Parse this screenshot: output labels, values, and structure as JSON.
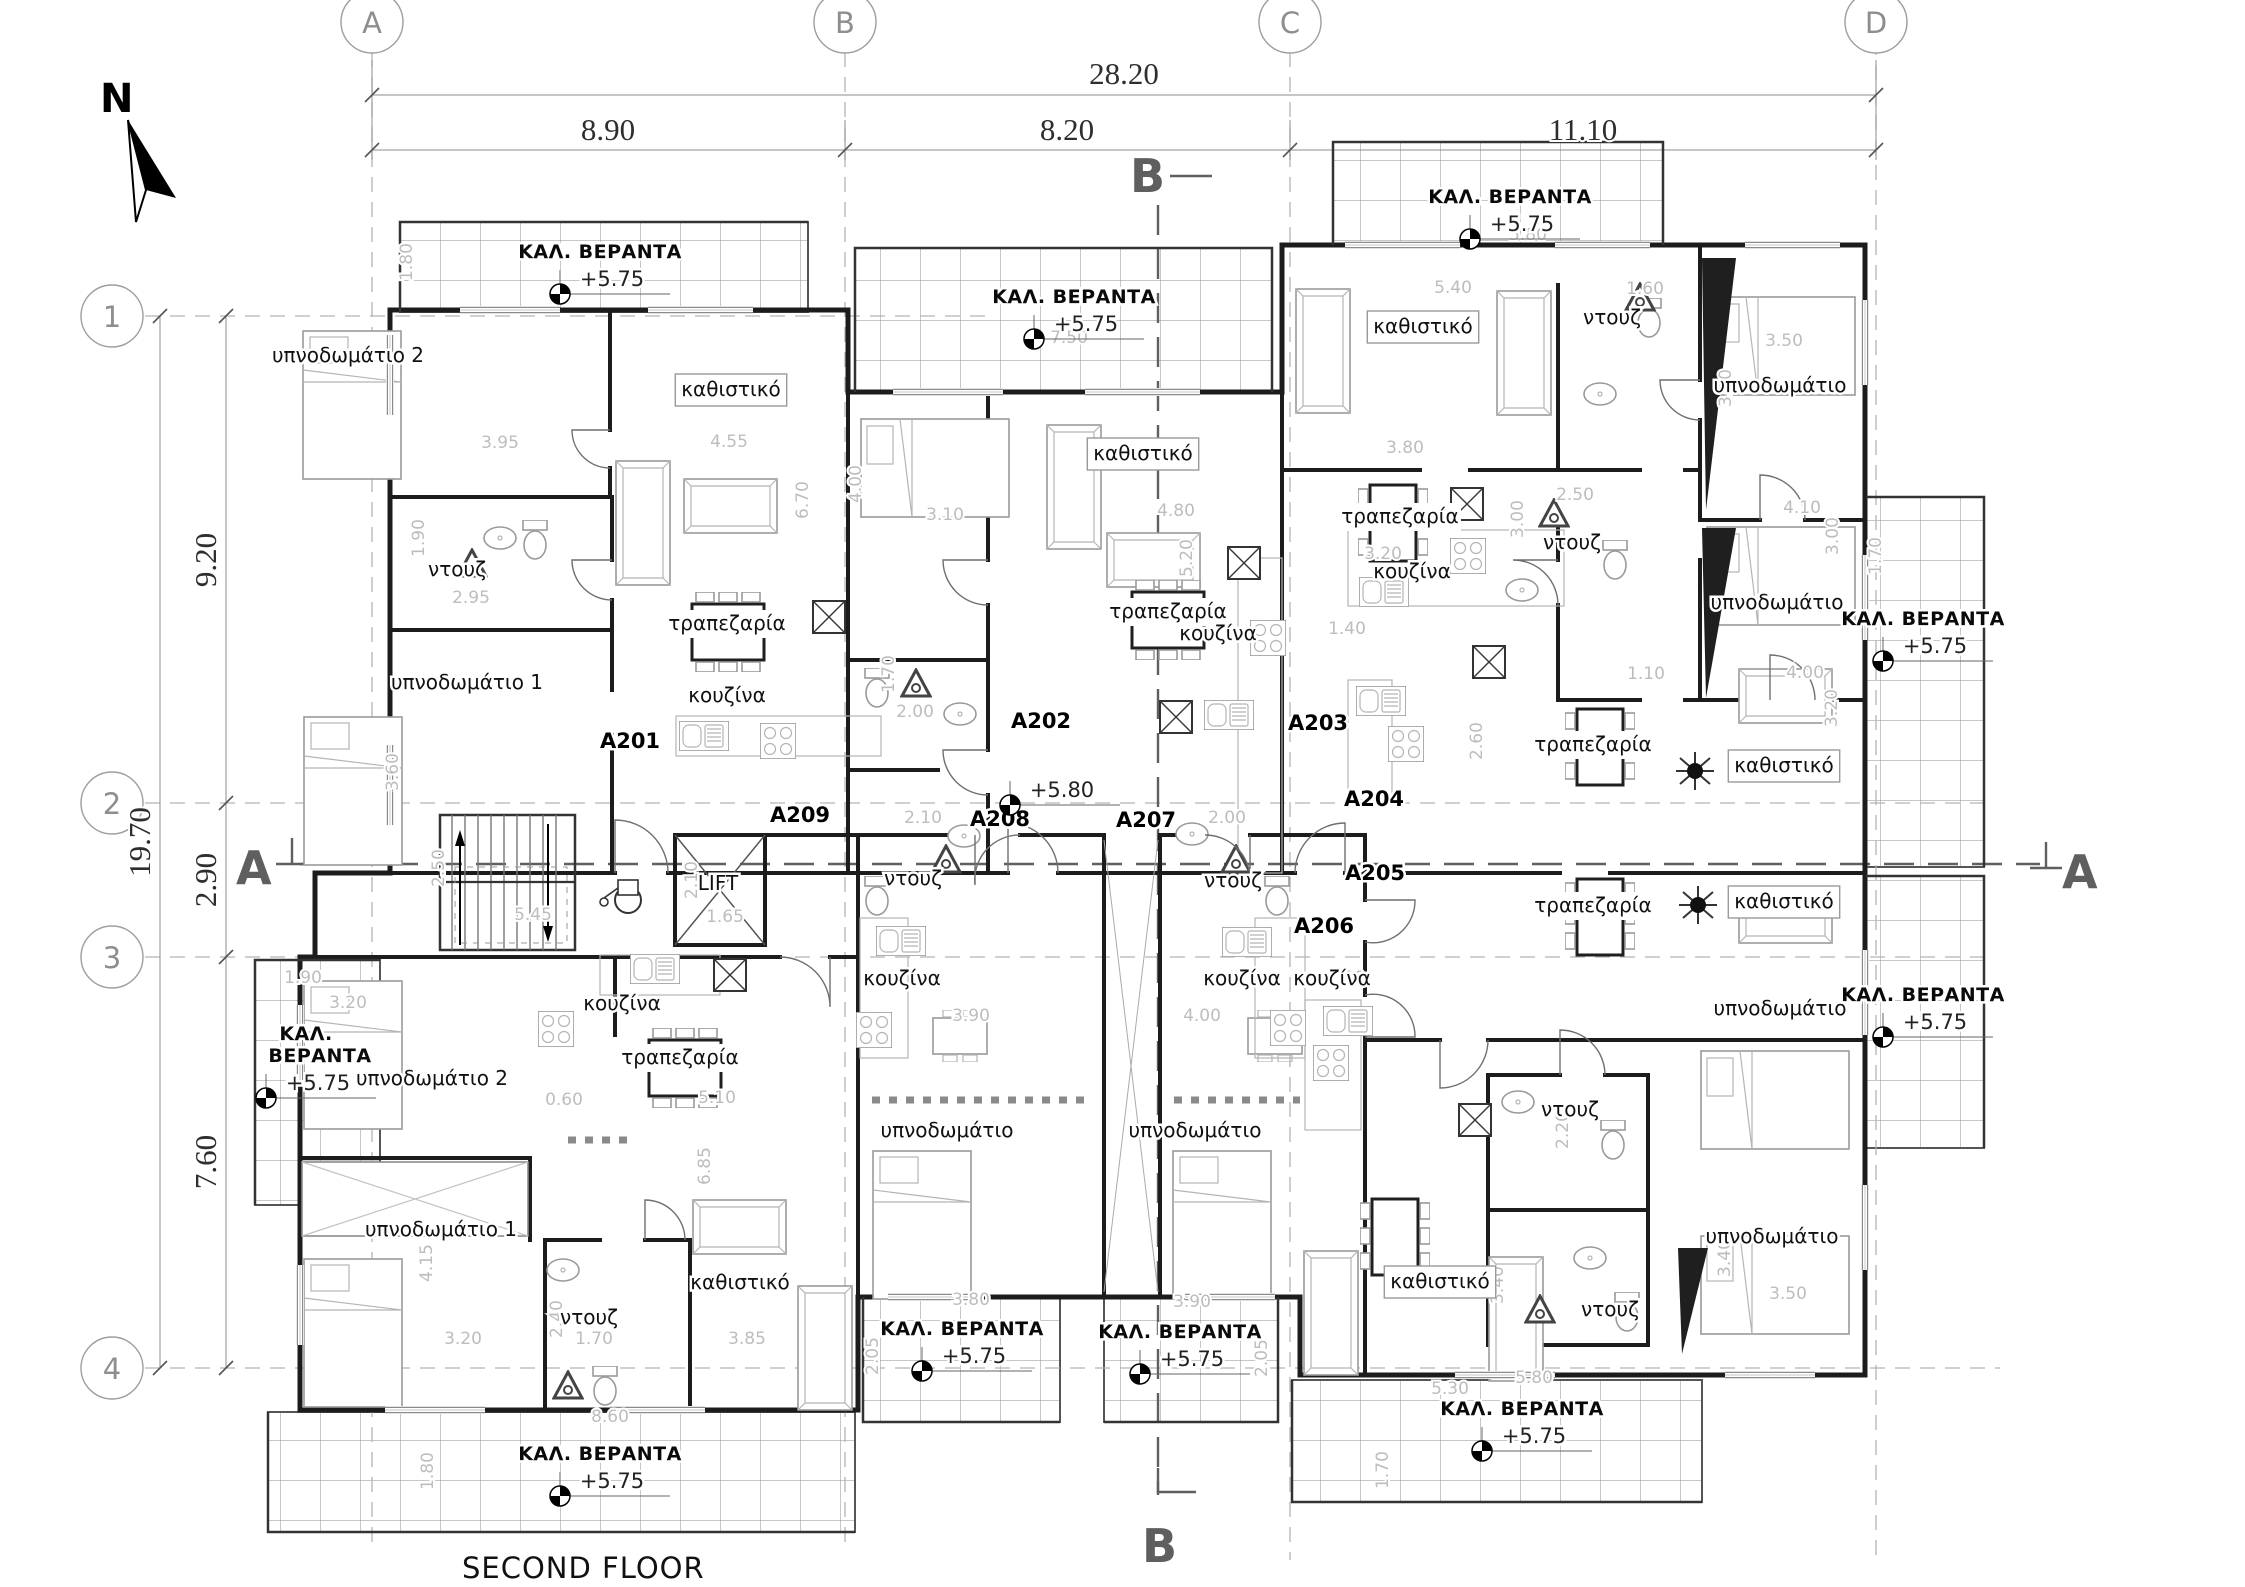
{
  "title": "SECOND FLOOR",
  "plan": {
    "north_label": "N",
    "lift_label": "LIFT",
    "veranda_label": "ΚΑΛ. ΒΕΡΑΝΤΑ",
    "veranda_level": "+5.75",
    "floor_level": "+5.80",
    "grid_columns": [
      {
        "label": "A",
        "x": 372
      },
      {
        "label": "B",
        "x": 845
      },
      {
        "label": "C",
        "x": 1290
      },
      {
        "label": "D",
        "x": 1876
      }
    ],
    "grid_rows": [
      {
        "label": "1",
        "y": 316
      },
      {
        "label": "2",
        "y": 803
      },
      {
        "label": "3",
        "y": 957
      },
      {
        "label": "4",
        "y": 1368
      }
    ],
    "dimensions": {
      "top_total": "28.20",
      "top_segments": [
        "8.90",
        "8.20",
        "11.10"
      ],
      "left_total": "19.70",
      "left_segments": [
        "9.20",
        "2.90",
        "7.60"
      ]
    },
    "dimension_texts": [
      {
        "t": "28.20",
        "x": 1124,
        "y": 84
      },
      {
        "t": "8.90",
        "x": 608,
        "y": 140
      },
      {
        "t": "8.20",
        "x": 1067,
        "y": 140
      },
      {
        "t": "11.10",
        "x": 1583,
        "y": 140
      },
      {
        "t": "19.70",
        "x": 150,
        "y": 842,
        "r": 1
      },
      {
        "t": "9.20",
        "x": 216,
        "y": 560,
        "r": 1
      },
      {
        "t": "2.90",
        "x": 216,
        "y": 880,
        "r": 1
      },
      {
        "t": "7.60",
        "x": 216,
        "y": 1162,
        "r": 1
      }
    ],
    "section_letters": [
      {
        "t": "A",
        "x": 236,
        "y": 884
      },
      {
        "t": "A",
        "x": 2062,
        "y": 888
      },
      {
        "t": "B",
        "x": 1130,
        "y": 192
      },
      {
        "t": "B",
        "x": 1142,
        "y": 1562
      }
    ],
    "apartments": [
      {
        "t": "A201",
        "x": 630,
        "y": 748
      },
      {
        "t": "A202",
        "x": 1041,
        "y": 728
      },
      {
        "t": "A203",
        "x": 1318,
        "y": 730
      },
      {
        "t": "A204",
        "x": 1374,
        "y": 806
      },
      {
        "t": "A205",
        "x": 1375,
        "y": 880
      },
      {
        "t": "A206",
        "x": 1324,
        "y": 933
      },
      {
        "t": "A207",
        "x": 1146,
        "y": 827
      },
      {
        "t": "A208",
        "x": 1000,
        "y": 826
      },
      {
        "t": "A209",
        "x": 800,
        "y": 822
      }
    ],
    "veranda_labels": [
      {
        "x": 600,
        "y": 258
      },
      {
        "x": 1074,
        "y": 303
      },
      {
        "x": 1510,
        "y": 203
      },
      {
        "x": 306,
        "y": 1040,
        "two_line": true
      },
      {
        "x": 1923,
        "y": 625
      },
      {
        "x": 1923,
        "y": 1001
      },
      {
        "x": 600,
        "y": 1460
      },
      {
        "x": 962,
        "y": 1335
      },
      {
        "x": 1180,
        "y": 1338
      },
      {
        "x": 1522,
        "y": 1415
      }
    ],
    "floor_level_pos": {
      "x": 1062,
      "y": 797
    },
    "room_labels": [
      {
        "t": "υπνοδωμάτιο 2",
        "x": 348,
        "y": 362
      },
      {
        "t": "καθιστικό",
        "x": 731,
        "y": 396,
        "p": "box"
      },
      {
        "t": "ντουζ",
        "x": 457,
        "y": 576
      },
      {
        "t": "υπνοδωμάτιο 1",
        "x": 467,
        "y": 689
      },
      {
        "t": "τραπεζαρία",
        "x": 727,
        "y": 630,
        "p": "plate"
      },
      {
        "t": "κουζίνα",
        "x": 727,
        "y": 702
      },
      {
        "t": "καθιστικό",
        "x": 1143,
        "y": 460,
        "p": "box"
      },
      {
        "t": "τραπεζαρία",
        "x": 1168,
        "y": 618,
        "p": "plate"
      },
      {
        "t": "κουζίνα",
        "x": 1218,
        "y": 640
      },
      {
        "t": "ντουζ",
        "x": 913,
        "y": 885
      },
      {
        "t": "κουζίνα",
        "x": 902,
        "y": 985
      },
      {
        "t": "υπνοδωμάτιο",
        "x": 947,
        "y": 1137
      },
      {
        "t": "ντουζ",
        "x": 1233,
        "y": 887
      },
      {
        "t": "κουζίνα",
        "x": 1242,
        "y": 985
      },
      {
        "t": "υπνοδωμάτιο",
        "x": 1195,
        "y": 1137
      },
      {
        "t": "καθιστικό",
        "x": 1423,
        "y": 333,
        "p": "box"
      },
      {
        "t": "ντουζ",
        "x": 1612,
        "y": 324
      },
      {
        "t": "υπνοδωμάτιο",
        "x": 1780,
        "y": 392
      },
      {
        "t": "τραπεζαρία",
        "x": 1400,
        "y": 523,
        "p": "plate"
      },
      {
        "t": "κουζίνα",
        "x": 1412,
        "y": 578
      },
      {
        "t": "ντουζ",
        "x": 1572,
        "y": 549
      },
      {
        "t": "υπνοδωμάτιο",
        "x": 1777,
        "y": 609
      },
      {
        "t": "τραπεζαρία",
        "x": 1593,
        "y": 751,
        "p": "plate"
      },
      {
        "t": "καθιστικό",
        "x": 1784,
        "y": 772,
        "p": "box"
      },
      {
        "t": "τραπεζαρία",
        "x": 1593,
        "y": 912,
        "p": "plate"
      },
      {
        "t": "καθιστικό",
        "x": 1784,
        "y": 908,
        "p": "box"
      },
      {
        "t": "κουζίνα",
        "x": 1332,
        "y": 985
      },
      {
        "t": "υπνοδωμάτιο",
        "x": 1780,
        "y": 1015
      },
      {
        "t": "ντουζ",
        "x": 1570,
        "y": 1116
      },
      {
        "t": "κουζίνα",
        "x": 622,
        "y": 1010
      },
      {
        "t": "υπνοδωμάτιο 2",
        "x": 432,
        "y": 1085
      },
      {
        "t": "τραπεζαρία",
        "x": 680,
        "y": 1064,
        "p": "plate"
      },
      {
        "t": "υπνοδωμάτιο 1",
        "x": 441,
        "y": 1236
      },
      {
        "t": "ντουζ",
        "x": 589,
        "y": 1324
      },
      {
        "t": "καθιστικό",
        "x": 740,
        "y": 1289
      },
      {
        "t": "καθιστικό",
        "x": 1440,
        "y": 1288,
        "p": "box"
      },
      {
        "t": "ντουζ",
        "x": 1610,
        "y": 1316
      },
      {
        "t": "υπνοδωμάτιο",
        "x": 1772,
        "y": 1243
      },
      {
        "t": "LIFT",
        "x": 718,
        "y": 890
      }
    ],
    "interior_dims": [
      [
        "3.95",
        500,
        448
      ],
      [
        "2.95",
        471,
        603
      ],
      [
        "4.55",
        729,
        447
      ],
      [
        "6.70",
        808,
        500,
        1
      ],
      [
        "3.10",
        945,
        520
      ],
      [
        "4.80",
        1176,
        516
      ],
      [
        "5.20",
        1192,
        558,
        1
      ],
      [
        "1.70",
        894,
        674,
        1
      ],
      [
        "2.00",
        915,
        717
      ],
      [
        "3.80",
        1405,
        453
      ],
      [
        "2.50",
        1575,
        500
      ],
      [
        "3.00",
        1523,
        519,
        1
      ],
      [
        "3.00",
        1838,
        536,
        1
      ],
      [
        "4.10",
        1802,
        513
      ],
      [
        "3.20",
        1383,
        559
      ],
      [
        "1.40",
        1347,
        634
      ],
      [
        "1.10",
        1646,
        679
      ],
      [
        "4.00",
        1805,
        678
      ],
      [
        "3.20",
        1837,
        708,
        1
      ],
      [
        "2.60",
        1482,
        741,
        1
      ],
      [
        "5.40",
        1453,
        293
      ],
      [
        "1.60",
        1645,
        294
      ],
      [
        "3.50",
        1784,
        346
      ],
      [
        "3.80",
        1731,
        388,
        1
      ],
      [
        "5.80",
        1528,
        240
      ],
      [
        "7.50",
        1069,
        343
      ],
      [
        "5.45",
        533,
        920
      ],
      [
        "1.65",
        725,
        922
      ],
      [
        "2.50",
        444,
        868,
        1
      ],
      [
        "2.10",
        697,
        880,
        1
      ],
      [
        "2.10",
        923,
        823
      ],
      [
        "2.00",
        1227,
        823
      ],
      [
        "3.90",
        971,
        1021
      ],
      [
        "4.00",
        1202,
        1021
      ],
      [
        "1.30",
        1346,
        983
      ],
      [
        "5.10",
        717,
        1103
      ],
      [
        "0.60",
        564,
        1105
      ],
      [
        "6.85",
        710,
        1166,
        1
      ],
      [
        "4.15",
        432,
        1263,
        1
      ],
      [
        "3.20",
        463,
        1344
      ],
      [
        "1.70",
        594,
        1344
      ],
      [
        "2.40",
        562,
        1319,
        1
      ],
      [
        "3.85",
        747,
        1344
      ],
      [
        "3.80",
        971,
        1305
      ],
      [
        "3.90",
        1192,
        1307
      ],
      [
        "2.05",
        878,
        1356,
        1
      ],
      [
        "2.05",
        1267,
        1358,
        1
      ],
      [
        "5.30",
        1450,
        1394
      ],
      [
        "3.40",
        1503,
        1285,
        1
      ],
      [
        "3.50",
        1788,
        1299
      ],
      [
        "3.40",
        1730,
        1258,
        1
      ],
      [
        "5.80",
        1534,
        1383
      ],
      [
        "8.60",
        610,
        1422
      ],
      [
        "1.80",
        433,
        1471,
        1
      ],
      [
        "1.90",
        303,
        983
      ],
      [
        "1.80",
        412,
        262,
        1
      ],
      [
        "1.70",
        1881,
        556,
        1
      ],
      [
        "1.70",
        1388,
        1470,
        1
      ],
      [
        "3.20",
        348,
        1008
      ],
      [
        "2.20",
        1568,
        1130,
        1
      ],
      [
        "4.00",
        861,
        484,
        1
      ],
      [
        "3.60",
        398,
        772,
        1
      ],
      [
        "1.90",
        424,
        538,
        1
      ]
    ],
    "colors": {
      "wall": "#1c1c1c",
      "dim_gray": "#bdbdbd",
      "grid_gray": "#b3b3b3",
      "section_gray": "#5f5f5f"
    }
  }
}
